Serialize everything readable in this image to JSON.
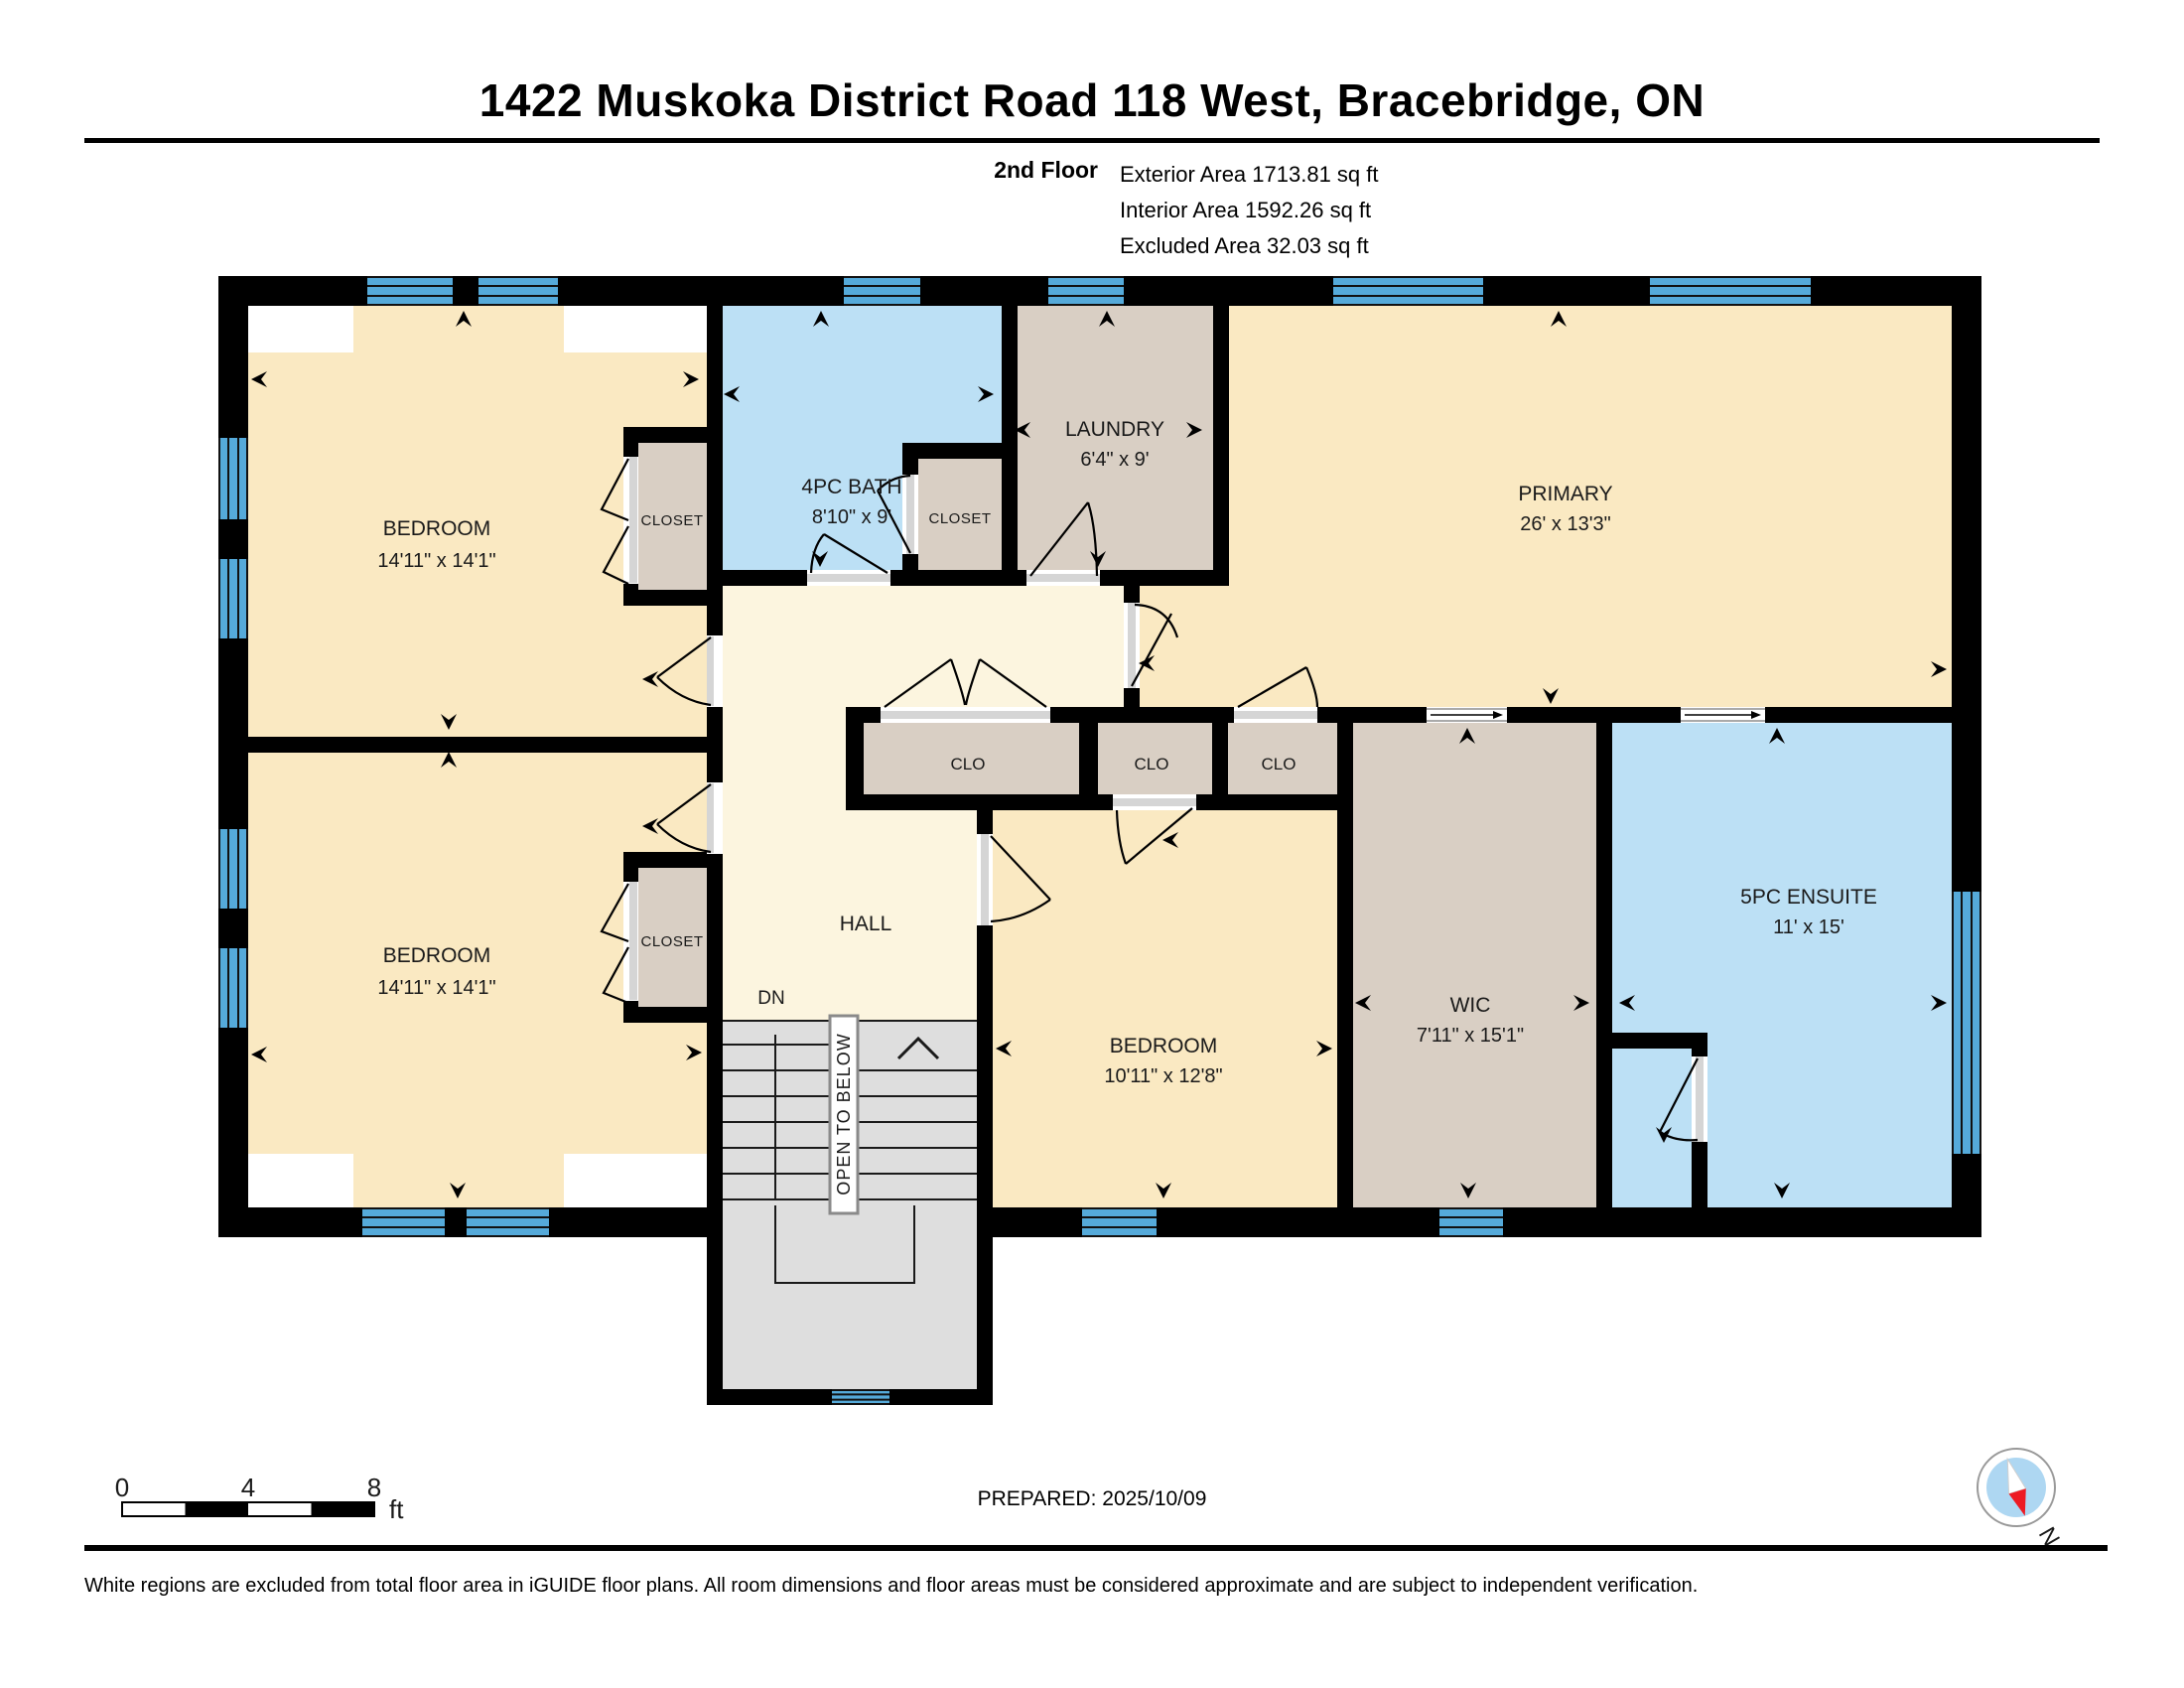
{
  "header": {
    "title": "1422 Muskoka District Road 118 West, Bracebridge, ON"
  },
  "summary": {
    "floor_label": "2nd Floor",
    "exterior": "Exterior Area 1713.81 sq ft",
    "interior": "Interior Area 1592.26 sq ft",
    "excluded": "Excluded Area 32.03 sq ft"
  },
  "rooms": {
    "bedroom_tl": {
      "name": "BEDROOM",
      "dims": "14'11\" x 14'1\""
    },
    "bedroom_bl": {
      "name": "BEDROOM",
      "dims": "14'11\" x 14'1\""
    },
    "bath": {
      "name": "4PC BATH",
      "dims": "8'10\" x 9'"
    },
    "laundry": {
      "name": "LAUNDRY",
      "dims": "6'4\" x 9'"
    },
    "primary": {
      "name": "PRIMARY",
      "dims": "26' x 13'3\""
    },
    "bedroom_mid": {
      "name": "BEDROOM",
      "dims": "10'11\" x 12'8\""
    },
    "wic": {
      "name": "WIC",
      "dims": "7'11\" x 15'1\""
    },
    "ensuite": {
      "name": "5PC ENSUITE",
      "dims": "11' x 15'"
    },
    "hall": {
      "name": "HALL"
    },
    "closet_tl": {
      "name": "CLOSET"
    },
    "closet_mid": {
      "name": "CLOSET"
    },
    "closet_bl": {
      "name": "CLOSET"
    },
    "clo_1": {
      "name": "CLO"
    },
    "clo_2": {
      "name": "CLO"
    },
    "clo_3": {
      "name": "CLO"
    }
  },
  "stairs": {
    "open_to_below": "OPEN TO BELOW",
    "down": "DN"
  },
  "scale_bar": {
    "t0": "0",
    "t4": "4",
    "t8": "8",
    "unit": "ft"
  },
  "compass": {
    "north": "N"
  },
  "footer": {
    "prepared": "PREPARED: 2025/10/09",
    "disclaimer": "White regions are excluded from total floor area in iGUIDE floor plans. All room dimensions and floor areas must be considered approximate and are subject to independent verification."
  },
  "colors": {
    "room_cream": "#FAE9C2",
    "hall_cream": "#FCF5DF",
    "wet_blue": "#BCE0F5",
    "closet_tan": "#D9CFC4",
    "stair_gray": "#DEDEDE",
    "window_blue": "#55AADA",
    "wall_black": "#000000",
    "sill_gray": "#D5D5D5",
    "compass_red": "#ED1B24",
    "compass_blue": "#AED7F2"
  }
}
